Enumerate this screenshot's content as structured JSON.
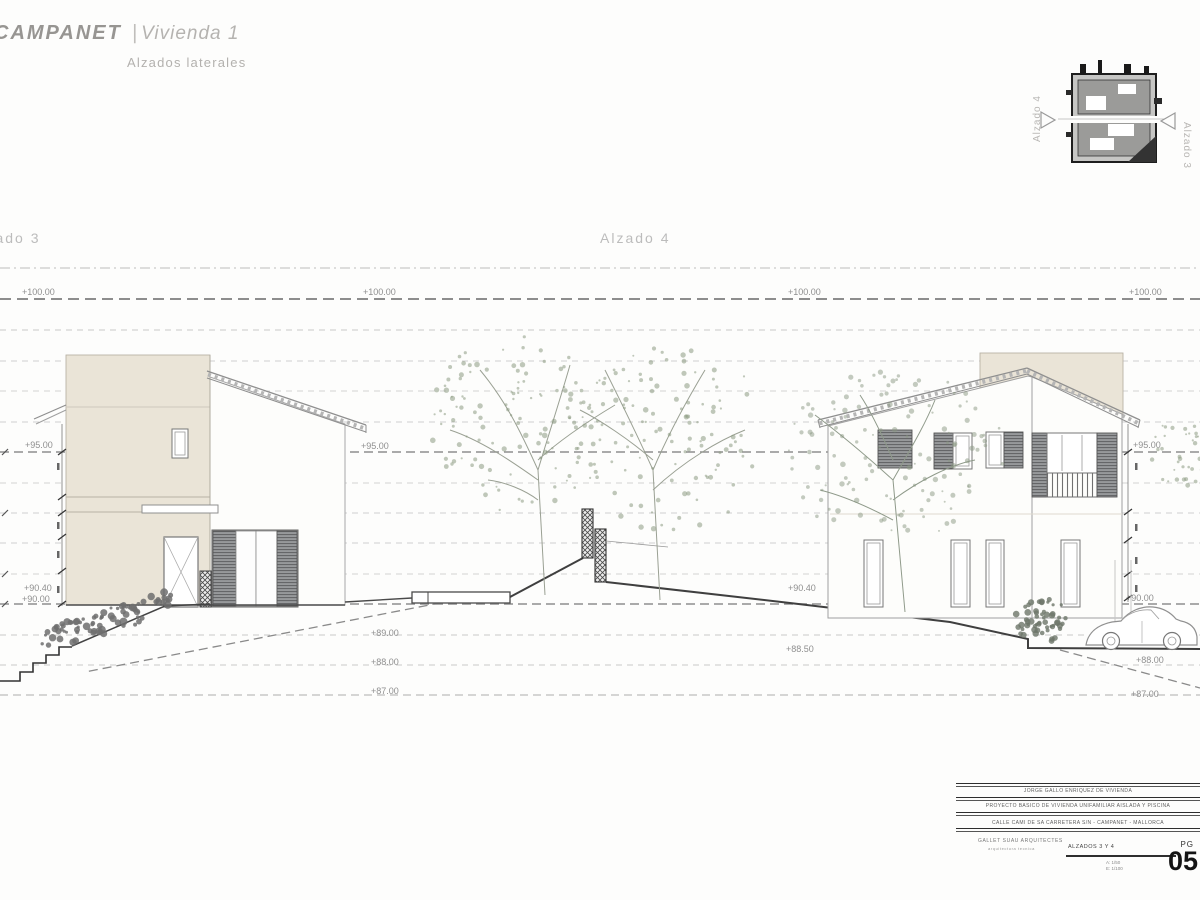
{
  "header": {
    "project": "CAMPANET",
    "separator": "|",
    "unit": "Vivienda 1",
    "subtitle": "Alzados laterales"
  },
  "drawing": {
    "left_section_label": "Alzado 3",
    "center_section_label": "Alzado 4"
  },
  "key_plan": {
    "west_label": "Alzado 4",
    "east_label": "Alzado 3"
  },
  "levels": {
    "l100": "+100.00",
    "l95": "+95.00",
    "l9040": "+90.40",
    "l90": "+90.00",
    "l89": "+89.00",
    "l8850": "+88.50",
    "l88": "+88.00",
    "l87": "+87.00"
  },
  "titleblock": {
    "client": "JORGE GALLO ENRIQUEZ DE VIVIENDA",
    "project": "PROYECTO BASICO DE VIVIENDA UNIFAMILIAR AISLADA Y PISCINA",
    "location": "CALLE CAMI DE SA CARRETERA S/N - CAMPANET - MALLORCA",
    "architect": "GALLET SUAU ARQUITECTES",
    "architect_sub": "arquitectura tecnica",
    "sheet_title": "ALZADOS 3 Y 4",
    "scale_a": "A: 1/50",
    "scale_b": "E: 1/100",
    "page_label": "PG",
    "page_number": "05"
  },
  "colors": {
    "wall_beige": "#eae4d7",
    "line_gray": "#9a9a9a",
    "foliage_green": "#8d9a82"
  }
}
